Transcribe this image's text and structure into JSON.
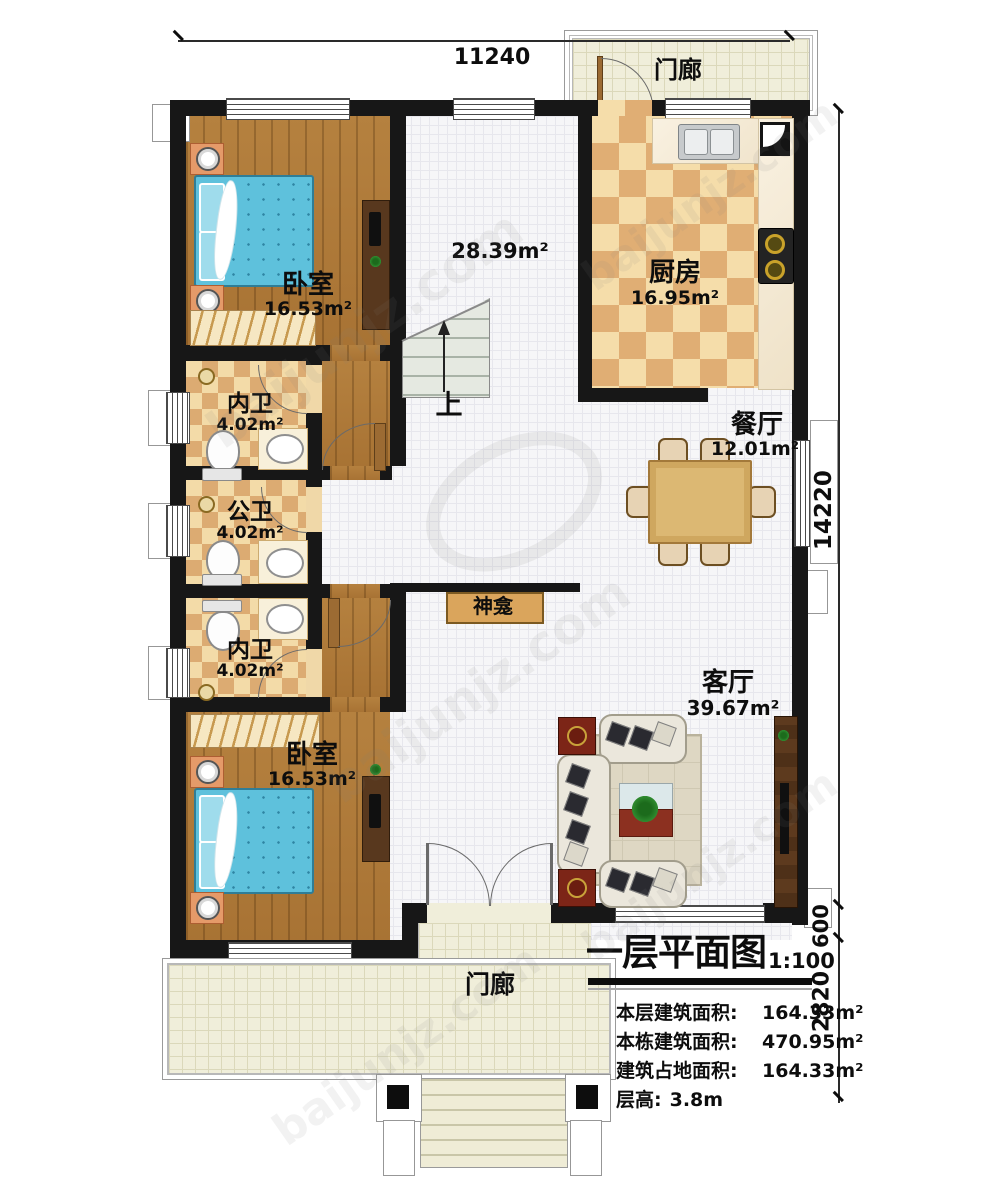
{
  "watermark": {
    "text": "baijunjz.com"
  },
  "dims": {
    "width": "11240",
    "height_main": "14220",
    "height_porch": "600",
    "height_steps": "2820"
  },
  "rooms": {
    "porch_top": {
      "label": "门廊"
    },
    "kitchen": {
      "label": "厨房",
      "area": "16.95m²"
    },
    "dining": {
      "label": "餐厅",
      "area": "12.01m²"
    },
    "bedroom_top": {
      "label": "卧室",
      "area": "16.53m²"
    },
    "bath_top": {
      "label": "内卫",
      "area": "4.02m²"
    },
    "bath_mid": {
      "label": "公卫",
      "area": "4.02m²"
    },
    "bath_bottom": {
      "label": "内卫",
      "area": "4.02m²"
    },
    "bedroom_bottom": {
      "label": "卧室",
      "area": "16.53m²"
    },
    "living": {
      "label": "客厅",
      "area": "39.67m²"
    },
    "hall": {
      "area": "28.39m²",
      "stairs_up": "上"
    },
    "shrine": {
      "label": "神龛"
    },
    "porch_bottom": {
      "label": "门廊"
    }
  },
  "title_block": {
    "title": "一层平面图",
    "scale": "1:100",
    "lines": [
      {
        "label": "本层建筑面积:",
        "value": "164.33m²"
      },
      {
        "label": "本栋建筑面积:",
        "value": "470.95m²"
      },
      {
        "label": "建筑占地面积:",
        "value": "164.33m²"
      },
      {
        "label": "层高:",
        "value": "3.8m"
      }
    ]
  }
}
